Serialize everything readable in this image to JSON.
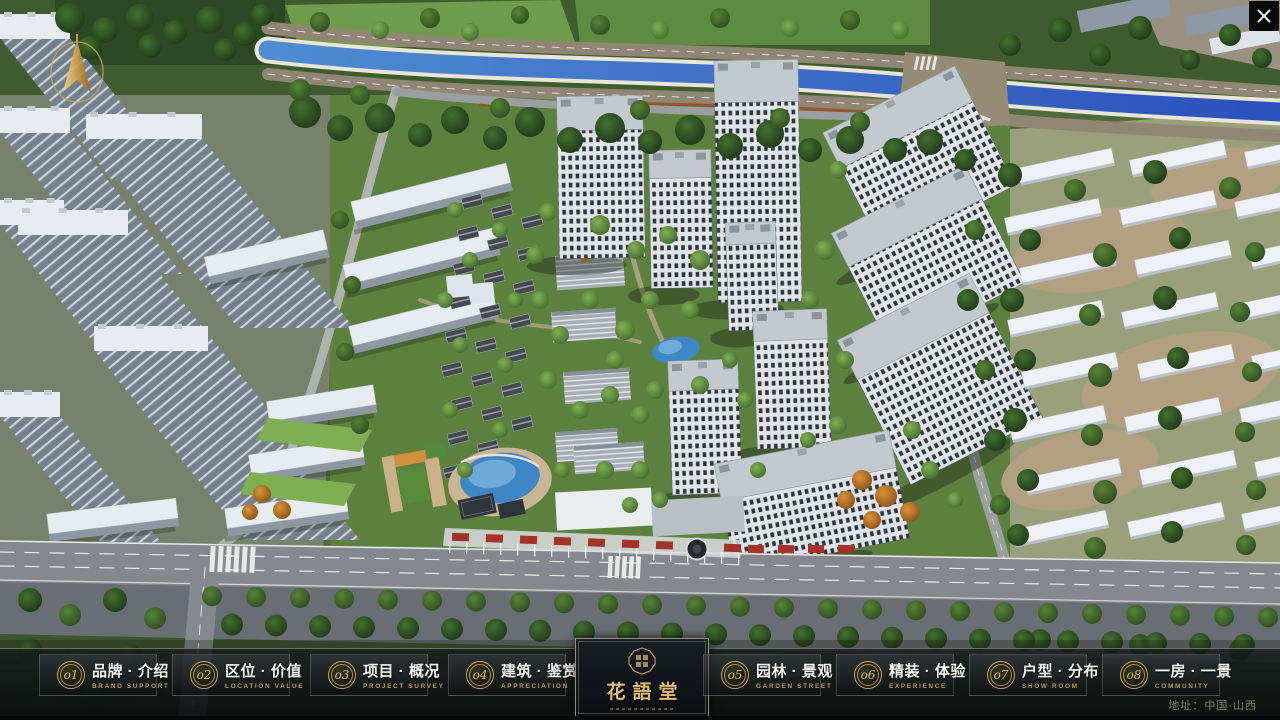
{
  "window": {
    "app_type": "real-estate sandbox presentation"
  },
  "nav": {
    "items": [
      {
        "num": "o1",
        "zh": "品牌 · 介绍",
        "en": "BRAND SUPPORT"
      },
      {
        "num": "o2",
        "zh": "区位 · 价值",
        "en": "LOCATION VALUE"
      },
      {
        "num": "o3",
        "zh": "项目 · 概况",
        "en": "PROJECT SURVEY"
      },
      {
        "num": "o4",
        "zh": "建筑 · 鉴赏",
        "en": "APPRECIATION"
      },
      {
        "num": "o5",
        "zh": "园林 · 景观",
        "en": "GARDEN STREET"
      },
      {
        "num": "o6",
        "zh": "精装 · 体验",
        "en": "EXPERIENCE"
      },
      {
        "num": "o7",
        "zh": "户型 · 分布",
        "en": "SHOW ROOM"
      },
      {
        "num": "o8",
        "zh": "一房 · 一景",
        "en": "COMMUNITY"
      }
    ],
    "address": "地址：中国·山西"
  },
  "logo": {
    "title": "花語堂"
  },
  "colors": {
    "accent_gold": "#c9a96a",
    "bar_background": "#0c0f12",
    "river_blue": "#2b50bc",
    "label_white": "#f4f4f1",
    "label_gold": "#b39a58"
  }
}
